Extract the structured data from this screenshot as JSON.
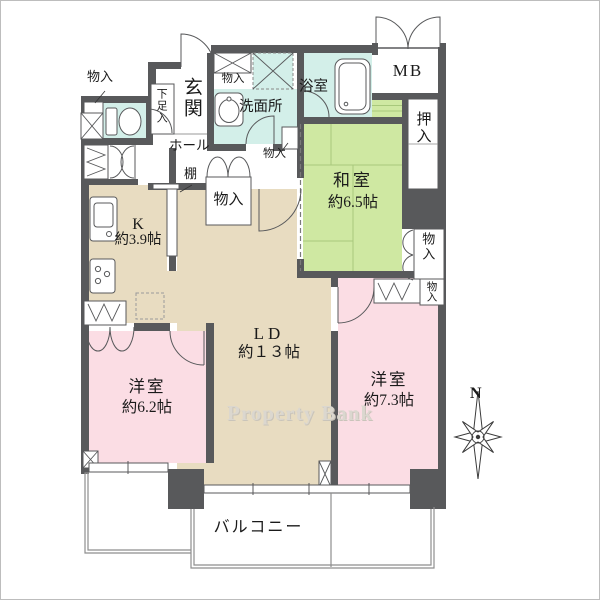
{
  "floorplan": {
    "watermark": "Property Bank",
    "compass_north": "N",
    "rooms": {
      "genkan": {
        "name": "玄関"
      },
      "shoe_box": {
        "name": "下足入"
      },
      "hall": {
        "name": "ホール"
      },
      "shelf": {
        "name": "棚"
      },
      "washroom": {
        "name": "洗面所"
      },
      "bathroom": {
        "name": "浴室"
      },
      "meter_box": {
        "name": "MB"
      },
      "oshiire": {
        "name": "押入"
      },
      "washitsu": {
        "name": "和室",
        "size": "約6.5帖"
      },
      "kitchen": {
        "name": "K",
        "size": "約3.9帖"
      },
      "living_dining": {
        "name": "LD",
        "size": "約１３帖"
      },
      "bedroom_west": {
        "name": "洋室",
        "size": "約6.2帖"
      },
      "bedroom_east": {
        "name": "洋室",
        "size": "約7.3帖"
      },
      "balcony": {
        "name": "バルコニー"
      }
    },
    "storage": {
      "closet_toilet": "物入",
      "closet_washroom": "物入",
      "closet_hall": "物入",
      "closet_ld": "物入",
      "closet_washitsu": "物入",
      "closet_bedroom_east": "物入"
    },
    "colors": {
      "wall": "#58595b",
      "tatami_green": "#cfe8a2",
      "wet_area_cyan": "#d3efe9",
      "wood_floor_beige": "#e8dcc1",
      "bedroom_pink": "#fbdde4"
    }
  }
}
